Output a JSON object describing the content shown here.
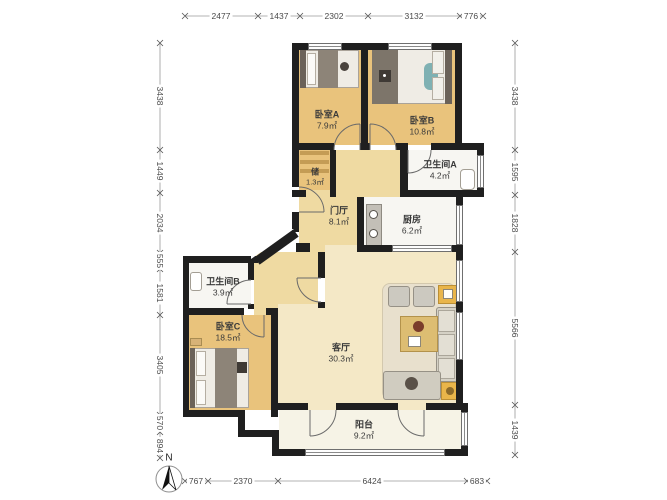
{
  "plan": {
    "rooms": [
      {
        "id": "bedroom-a",
        "name": "卧室A",
        "area": "7.9㎡"
      },
      {
        "id": "bedroom-b",
        "name": "卧室B",
        "area": "10.8㎡"
      },
      {
        "id": "storage",
        "name": "储",
        "area": "1.3㎡"
      },
      {
        "id": "bathroom-a",
        "name": "卫生间A",
        "area": "4.2㎡"
      },
      {
        "id": "foyer",
        "name": "门厅",
        "area": "8.1㎡"
      },
      {
        "id": "kitchen",
        "name": "厨房",
        "area": "6.2㎡"
      },
      {
        "id": "bathroom-b",
        "name": "卫生间B",
        "area": "3.9㎡"
      },
      {
        "id": "bedroom-c",
        "name": "卧室C",
        "area": "18.5㎡"
      },
      {
        "id": "living-room",
        "name": "客厅",
        "area": "30.3㎡"
      },
      {
        "id": "balcony",
        "name": "阳台",
        "area": "9.2㎡"
      }
    ],
    "dimensions": {
      "top": [
        "2477",
        "1437",
        "2302",
        "3132",
        "776"
      ],
      "bottom": [
        "767",
        "2370",
        "6424",
        "683"
      ],
      "left": [
        "3438",
        "1449",
        "2034",
        "555",
        "1581",
        "3405",
        "570",
        "894"
      ],
      "right": [
        "3438",
        "1595",
        "1828",
        "5566",
        "1439"
      ]
    },
    "compass": {
      "label": "N"
    },
    "colors": {
      "wall": "#1f1f1f",
      "bedroom_floor": "#e9c37c",
      "hall_floor": "#efdaa2",
      "living_floor": "#f4e8c6",
      "balcony_floor": "#f6f3e6",
      "wet_floor": "#f7f6f2",
      "accent_table": "#e9b54a",
      "sofa": "#d5d1c5",
      "blanket": "#8d8478"
    }
  }
}
